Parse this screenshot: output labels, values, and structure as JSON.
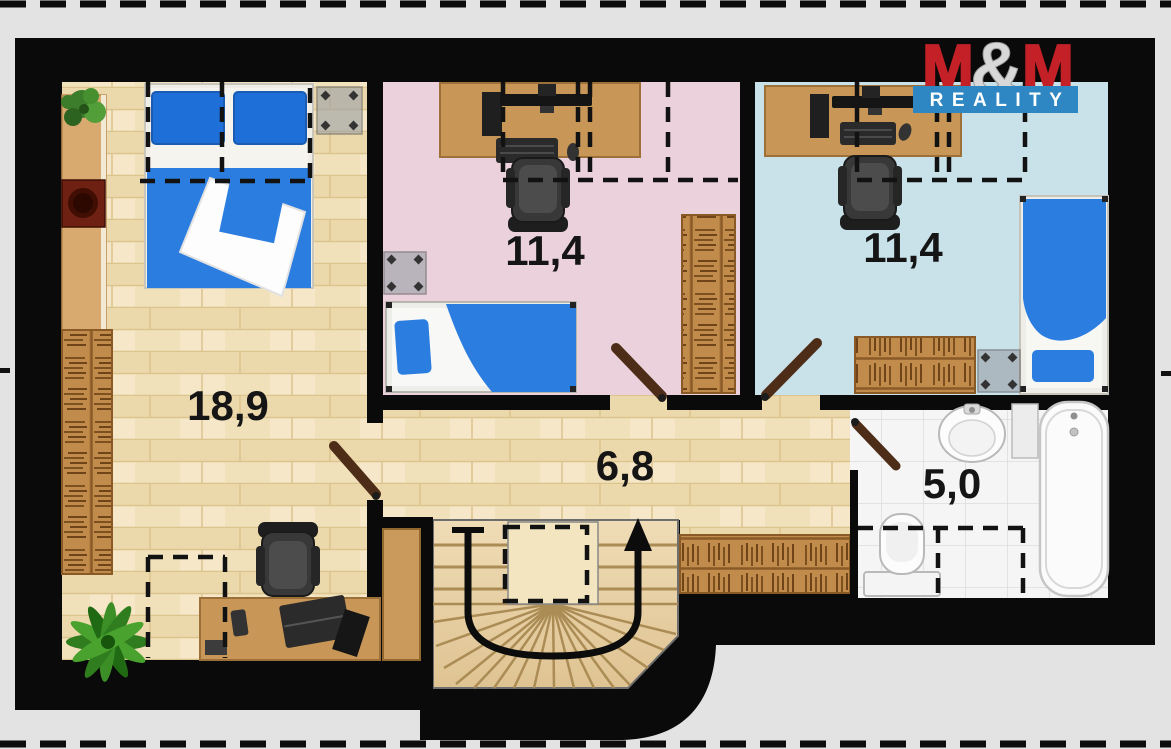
{
  "logo": {
    "m1": "M",
    "amp": "&",
    "m2": "M",
    "tagline": "REALITY",
    "red": "#c32127",
    "blue": "#2e86c2",
    "silver": "#d8d8d8"
  },
  "rooms": {
    "large_bedroom": {
      "area": "18,9"
    },
    "pink_bedroom": {
      "area": "11,4"
    },
    "blue_bedroom": {
      "area": "11,4"
    },
    "hallway": {
      "area": "6,8"
    },
    "bathroom": {
      "area": "5,0"
    }
  },
  "palette": {
    "background": "#e3e3e3",
    "wall": "#0a0a0a",
    "wood_floor": "#f0dfb8",
    "pink_floor": "#ead1dc",
    "blue_floor": "#c9e1e9",
    "bath_floor": "#f4f4f4",
    "furniture_wood": "#c89758",
    "bed_blue": "#2b7de0"
  }
}
